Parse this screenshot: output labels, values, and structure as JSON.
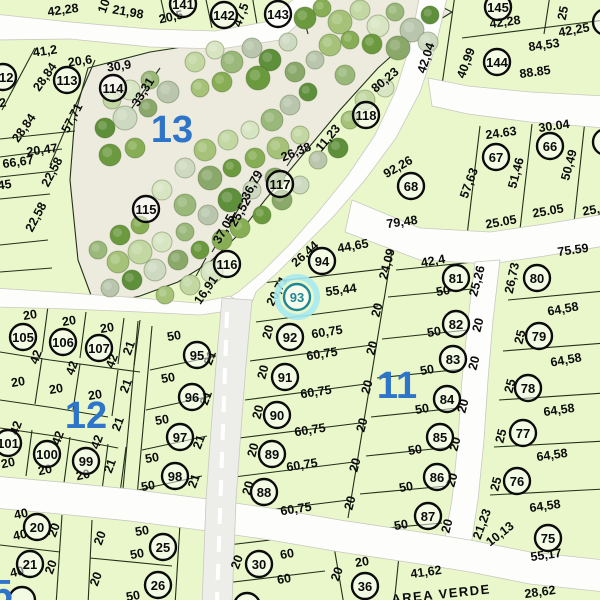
{
  "map": {
    "title": "parcel-plat-map",
    "colors": {
      "lot_fill": "#e9f7cb",
      "park_fill": "#ecebde",
      "road_fill": "#fdfdfb",
      "road_center_fill": "#ededea",
      "road_edge": "#c9c9c0",
      "parcel_line": "#22301a",
      "label_text": "#0b0b0b",
      "block_blue": "#2e75c9",
      "circle_stroke": "#0c0c0c",
      "highlight_teal": "#1e8796",
      "highlight_halo": "#a7e9ef",
      "tree_palette": [
        "#6b9a3e",
        "#87ae54",
        "#a5c278",
        "#c3d7a2",
        "#d8e5c2",
        "#9ab87a",
        "#b9c6ad",
        "#5e8f3a",
        "#cdd9c0",
        "#8aa86a"
      ]
    },
    "blocks": [
      [
        "13",
        172,
        130
      ],
      [
        "12",
        86,
        416
      ],
      [
        "11",
        397,
        386
      ],
      [
        "5",
        2,
        594
      ]
    ],
    "highlight": {
      "n": "93",
      "x": 297,
      "y": 297
    },
    "lots": [
      [
        "112",
        3,
        77
      ],
      [
        "113",
        67,
        80
      ],
      [
        "114",
        113,
        88
      ],
      [
        "141",
        183,
        4
      ],
      [
        "142",
        224,
        15
      ],
      [
        "143",
        278,
        14
      ],
      [
        "145",
        498,
        7
      ],
      [
        "144",
        497,
        62
      ],
      [
        "115",
        146,
        209
      ],
      [
        "116",
        227,
        264
      ],
      [
        "117",
        280,
        184
      ],
      [
        "118",
        366,
        115
      ],
      [
        "67",
        496,
        157
      ],
      [
        "66",
        550,
        146
      ],
      [
        "68",
        411,
        186
      ],
      [
        "94",
        322,
        261
      ],
      [
        "81",
        456,
        278
      ],
      [
        "80",
        537,
        278
      ],
      [
        "82",
        456,
        324
      ],
      [
        "79",
        539,
        336
      ],
      [
        "83",
        453,
        359
      ],
      [
        "78",
        528,
        388
      ],
      [
        "84",
        447,
        399
      ],
      [
        "85",
        440,
        437
      ],
      [
        "86",
        437,
        477
      ],
      [
        "87",
        428,
        516
      ],
      [
        "77",
        523,
        433
      ],
      [
        "76",
        517,
        481
      ],
      [
        "75",
        548,
        538
      ],
      [
        "95",
        197,
        355
      ],
      [
        "92",
        290,
        337
      ],
      [
        "91",
        285,
        377
      ],
      [
        "96",
        192,
        397
      ],
      [
        "90",
        277,
        415
      ],
      [
        "97",
        180,
        437
      ],
      [
        "98",
        175,
        476
      ],
      [
        "89",
        272,
        454
      ],
      [
        "88",
        264,
        492
      ],
      [
        "105",
        23,
        337
      ],
      [
        "106",
        63,
        342
      ],
      [
        "107",
        99,
        348
      ],
      [
        "101",
        8,
        443
      ],
      [
        "100",
        47,
        454
      ],
      [
        "99",
        86,
        461
      ],
      [
        "20",
        37,
        527
      ],
      [
        "21",
        30,
        564
      ],
      [
        "25",
        163,
        547
      ],
      [
        "26",
        158,
        585
      ],
      [
        "30",
        259,
        564
      ],
      [
        "36",
        365,
        586
      ],
      [
        "31",
        247,
        606
      ]
    ],
    "partial_circles": [
      [
        606,
        22
      ],
      [
        606,
        142
      ],
      [
        22,
        600
      ]
    ],
    "dims": [
      [
        "42,28",
        63,
        10,
        -8
      ],
      [
        "21,98",
        128,
        12,
        10
      ],
      [
        "10",
        104,
        6,
        -70
      ],
      [
        "20,5",
        171,
        17,
        -12
      ],
      [
        "47,5",
        241,
        15,
        -70
      ],
      [
        "41,2",
        45,
        51,
        -8
      ],
      [
        "20,6",
        80,
        61,
        -8
      ],
      [
        "30,9",
        119,
        66,
        -8
      ],
      [
        "28,84",
        45,
        77,
        -55
      ],
      [
        "57,71",
        72,
        118,
        -62
      ],
      [
        "33,31",
        143,
        92,
        -58
      ],
      [
        "41,2",
        -6,
        104,
        -8
      ],
      [
        "28,84",
        24,
        128,
        -55
      ],
      [
        "20,47",
        42,
        150,
        -8
      ],
      [
        "66,67",
        18,
        162,
        -8
      ],
      [
        "65,45",
        -4,
        186,
        -8
      ],
      [
        "22,58",
        52,
        172,
        -62
      ],
      [
        "22,58",
        36,
        217,
        -62
      ],
      [
        "42,28",
        505,
        22,
        -8
      ],
      [
        "25",
        563,
        13,
        -78
      ],
      [
        "42,25",
        574,
        30,
        -10
      ],
      [
        "84,53",
        544,
        45,
        -8
      ],
      [
        "88.85",
        535,
        72,
        -8
      ],
      [
        "40,99",
        466,
        63,
        -70
      ],
      [
        "80,23",
        385,
        80,
        -40
      ],
      [
        "42,04",
        426,
        58,
        -72
      ],
      [
        "11,23",
        328,
        138,
        -50
      ],
      [
        "26,38",
        296,
        152,
        -22
      ],
      [
        "36,79",
        252,
        185,
        -62
      ],
      [
        "25,52",
        240,
        212,
        -60
      ],
      [
        "37,05",
        224,
        229,
        -60
      ],
      [
        "16,91",
        206,
        290,
        -55
      ],
      [
        "92,26",
        398,
        167,
        -30
      ],
      [
        "79,48",
        402,
        222,
        -8
      ],
      [
        "24.63",
        501,
        133,
        -8
      ],
      [
        "30.04",
        554,
        126,
        -8
      ],
      [
        "57,63",
        469,
        183,
        -70
      ],
      [
        "51,46",
        516,
        173,
        -75
      ],
      [
        "50,49",
        569,
        165,
        -75
      ],
      [
        "25.05",
        501,
        222,
        -10
      ],
      [
        "25.05",
        548,
        211,
        -10
      ],
      [
        "25,05",
        598,
        209,
        -10
      ],
      [
        "75.59",
        573,
        250,
        -8
      ],
      [
        "26,44",
        305,
        254,
        -42
      ],
      [
        "20,71",
        277,
        291,
        -62
      ],
      [
        "44,65",
        353,
        246,
        -10
      ],
      [
        "24,09",
        387,
        264,
        -75
      ],
      [
        "42,4",
        433,
        261,
        -10
      ],
      [
        "50",
        443,
        291,
        -10
      ],
      [
        "55,44",
        341,
        290,
        -8
      ],
      [
        "26,73",
        512,
        278,
        -78
      ],
      [
        "25,26",
        477,
        281,
        -75
      ],
      [
        "64,58",
        563,
        309,
        -10
      ],
      [
        "64,58",
        566,
        360,
        -10
      ],
      [
        "64,58",
        559,
        410,
        -8
      ],
      [
        "64,58",
        552,
        455,
        -8
      ],
      [
        "64,58",
        545,
        506,
        -8
      ],
      [
        "20",
        478,
        325,
        -75
      ],
      [
        "20",
        474,
        363,
        -75
      ],
      [
        "25",
        520,
        337,
        -75
      ],
      [
        "25",
        510,
        386,
        -75
      ],
      [
        "25",
        501,
        436,
        -75
      ],
      [
        "25",
        496,
        484,
        -75
      ],
      [
        "20",
        463,
        406,
        -75
      ],
      [
        "20",
        455,
        444,
        -75
      ],
      [
        "20",
        452,
        480,
        -75
      ],
      [
        "20",
        447,
        526,
        -75
      ],
      [
        "21,23",
        482,
        524,
        -70
      ],
      [
        "10,13",
        500,
        534,
        -38
      ],
      [
        "55,17",
        546,
        555,
        -8
      ],
      [
        "28,62",
        540,
        592,
        -8
      ],
      [
        "41,62",
        426,
        572,
        -8
      ],
      [
        "60,75",
        327,
        332,
        -9
      ],
      [
        "60,75",
        322,
        354,
        -9
      ],
      [
        "60,75",
        316,
        392,
        -9
      ],
      [
        "60,75",
        310,
        430,
        -9
      ],
      [
        "60,75",
        302,
        465,
        -9
      ],
      [
        "60,75",
        296,
        509,
        -9
      ],
      [
        "20",
        377,
        310,
        -75
      ],
      [
        "20",
        372,
        348,
        -75
      ],
      [
        "20",
        367,
        387,
        -75
      ],
      [
        "20",
        362,
        425,
        -75
      ],
      [
        "20",
        355,
        465,
        -75
      ],
      [
        "20",
        350,
        503,
        -75
      ],
      [
        "20",
        268,
        332,
        -75
      ],
      [
        "20",
        263,
        372,
        -75
      ],
      [
        "20",
        258,
        412,
        -75
      ],
      [
        "20",
        253,
        450,
        -75
      ],
      [
        "20",
        248,
        488,
        -75
      ],
      [
        "50",
        434,
        332,
        -10
      ],
      [
        "50",
        427,
        370,
        -10
      ],
      [
        "50",
        422,
        409,
        -10
      ],
      [
        "50",
        415,
        450,
        -10
      ],
      [
        "50",
        406,
        487,
        -10
      ],
      [
        "50",
        401,
        525,
        -10
      ],
      [
        "20",
        30,
        315,
        -10
      ],
      [
        "20",
        69,
        321,
        -10
      ],
      [
        "20",
        107,
        328,
        -10
      ],
      [
        "42",
        36,
        357,
        -70
      ],
      [
        "42",
        72,
        368,
        -70
      ],
      [
        "42",
        112,
        361,
        -70
      ],
      [
        "21",
        129,
        348,
        -70
      ],
      [
        "21",
        126,
        386,
        -70
      ],
      [
        "21",
        118,
        424,
        -70
      ],
      [
        "20",
        18,
        382,
        -10
      ],
      [
        "20",
        56,
        389,
        -10
      ],
      [
        "20",
        95,
        395,
        -10
      ],
      [
        "42",
        16,
        428,
        -70
      ],
      [
        "42",
        58,
        438,
        -70
      ],
      [
        "42",
        97,
        442,
        -70
      ],
      [
        "20",
        8,
        463,
        -12
      ],
      [
        "20",
        45,
        470,
        -12
      ],
      [
        "20",
        83,
        475,
        -12
      ],
      [
        "21",
        110,
        466,
        -70
      ],
      [
        "50",
        174,
        336,
        -10
      ],
      [
        "50",
        168,
        378,
        -10
      ],
      [
        "50",
        162,
        420,
        -10
      ],
      [
        "21",
        210,
        358,
        -70
      ],
      [
        "21",
        206,
        398,
        -70
      ],
      [
        "21",
        199,
        442,
        -70
      ],
      [
        "21",
        194,
        481,
        -70
      ],
      [
        "50",
        152,
        458,
        -10
      ],
      [
        "50",
        148,
        486,
        -10
      ],
      [
        "40",
        21,
        514,
        -12
      ],
      [
        "40",
        20,
        535,
        -12
      ],
      [
        "20",
        54,
        530,
        -70
      ],
      [
        "40",
        17,
        572,
        -12
      ],
      [
        "20",
        51,
        567,
        -70
      ],
      [
        "20",
        100,
        538,
        -70
      ],
      [
        "50",
        142,
        531,
        -10
      ],
      [
        "50",
        137,
        554,
        -10
      ],
      [
        "20",
        96,
        579,
        -70
      ],
      [
        "50",
        133,
        596,
        -10
      ],
      [
        "20",
        237,
        562,
        -70
      ],
      [
        "60",
        287,
        554,
        -10
      ],
      [
        "60",
        284,
        579,
        -10
      ],
      [
        "20",
        337,
        574,
        -70
      ],
      [
        "20",
        362,
        562,
        -10
      ]
    ],
    "area_verde": {
      "text": "AREA VERDE",
      "x": 441,
      "y": 594,
      "r": -6
    }
  }
}
